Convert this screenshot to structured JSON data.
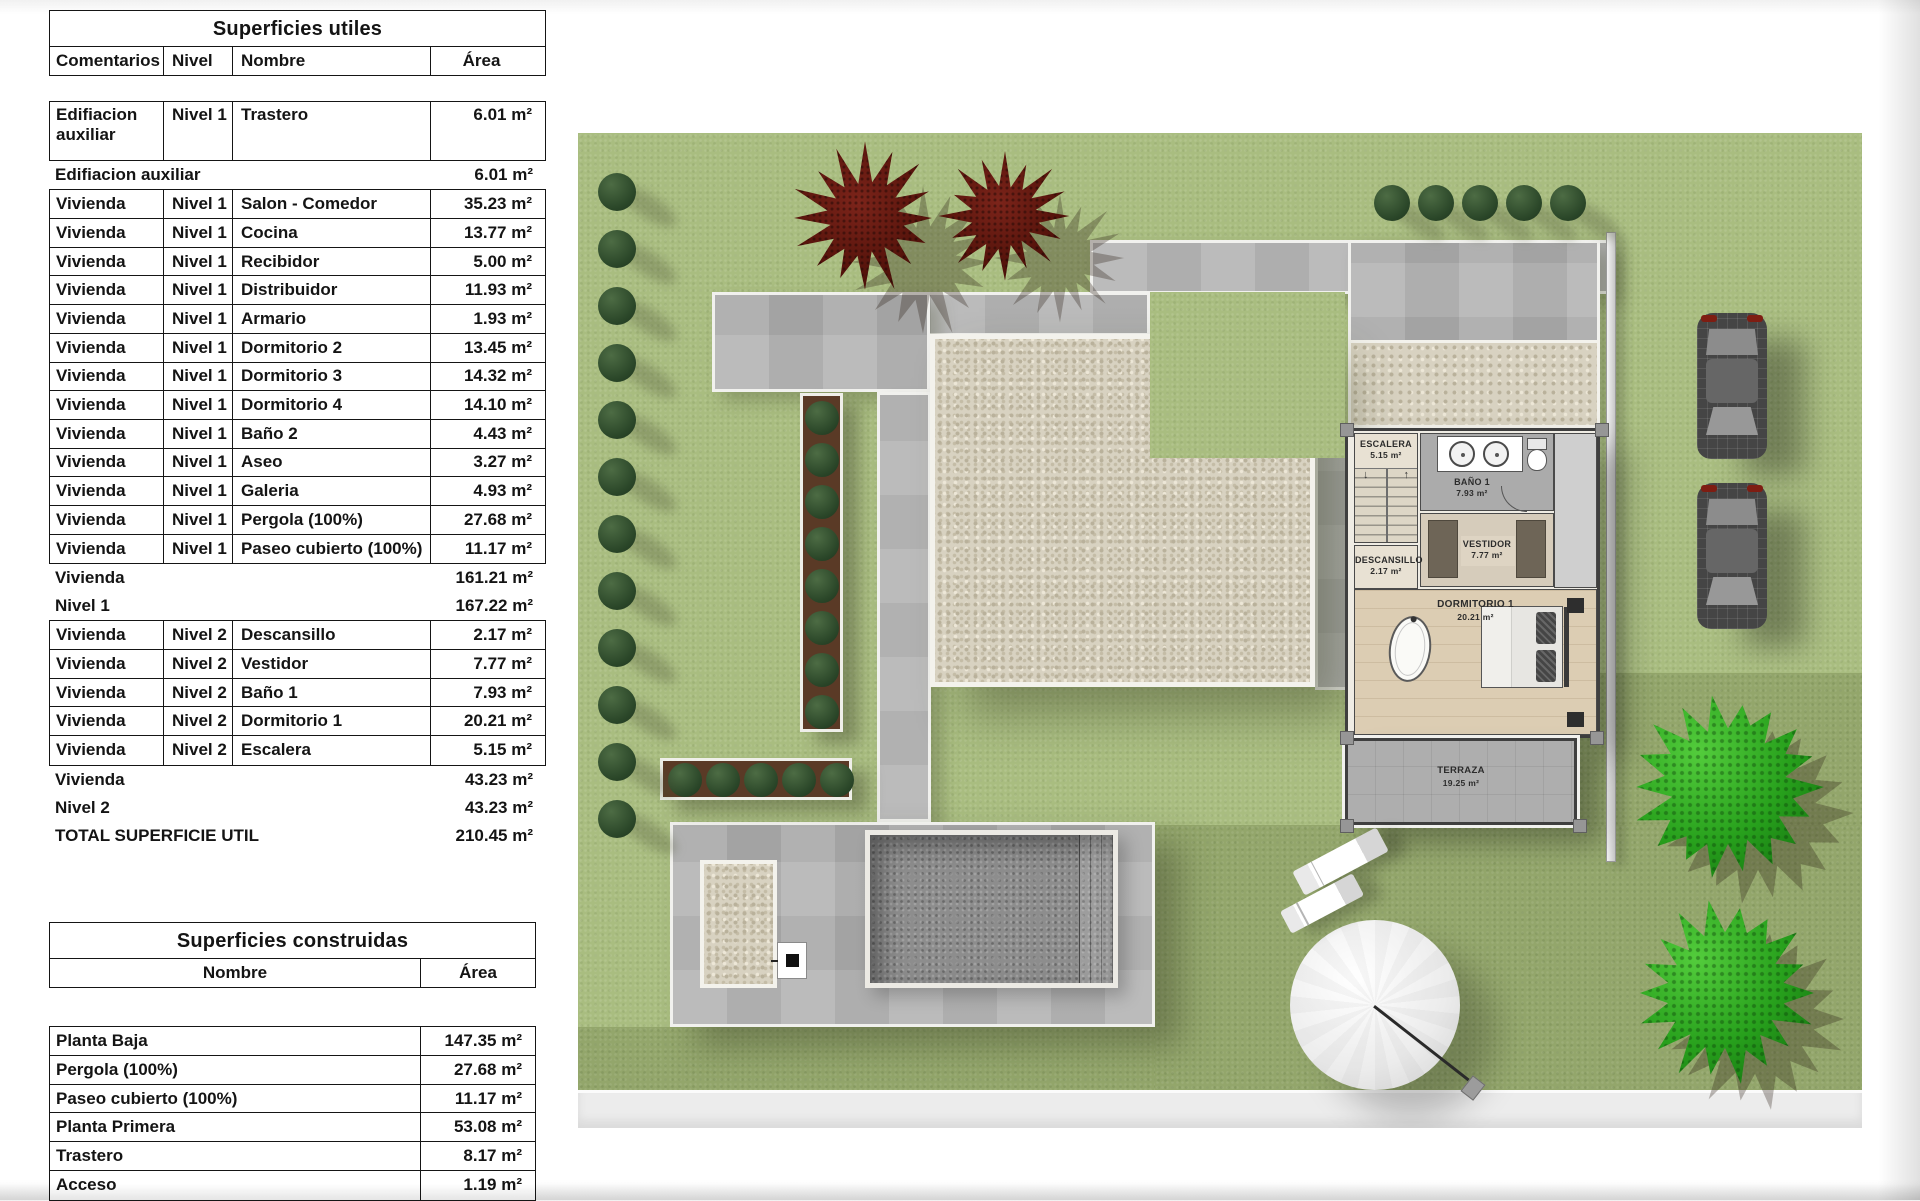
{
  "tables": {
    "utiles": {
      "title": "Superficies utiles",
      "headers": [
        "Comentarios",
        "Nivel",
        "Nombre",
        "Área"
      ],
      "rows": [
        {
          "type": "data",
          "tall": true,
          "comment": "Edifiacion auxiliar",
          "level": "Nivel 1",
          "name": "Trastero",
          "area": "6.01 m²"
        },
        {
          "type": "subtotal",
          "label": "Edifiacion auxiliar",
          "area": "6.01 m²"
        },
        {
          "type": "data",
          "comment": "Vivienda",
          "level": "Nivel 1",
          "name": "Salon - Comedor",
          "area": "35.23 m²"
        },
        {
          "type": "data",
          "comment": "Vivienda",
          "level": "Nivel 1",
          "name": "Cocina",
          "area": "13.77 m²"
        },
        {
          "type": "data",
          "comment": "Vivienda",
          "level": "Nivel 1",
          "name": "Recibidor",
          "area": "5.00 m²"
        },
        {
          "type": "data",
          "comment": "Vivienda",
          "level": "Nivel 1",
          "name": "Distribuidor",
          "area": "11.93 m²"
        },
        {
          "type": "data",
          "comment": "Vivienda",
          "level": "Nivel 1",
          "name": "Armario",
          "area": "1.93 m²"
        },
        {
          "type": "data",
          "comment": "Vivienda",
          "level": "Nivel 1",
          "name": "Dormitorio 2",
          "area": "13.45 m²"
        },
        {
          "type": "data",
          "comment": "Vivienda",
          "level": "Nivel 1",
          "name": "Dormitorio 3",
          "area": "14.32 m²"
        },
        {
          "type": "data",
          "comment": "Vivienda",
          "level": "Nivel 1",
          "name": "Dormitorio 4",
          "area": "14.10 m²"
        },
        {
          "type": "data",
          "comment": "Vivienda",
          "level": "Nivel 1",
          "name": "Baño 2",
          "area": "4.43 m²"
        },
        {
          "type": "data",
          "comment": "Vivienda",
          "level": "Nivel 1",
          "name": "Aseo",
          "area": "3.27 m²"
        },
        {
          "type": "data",
          "comment": "Vivienda",
          "level": "Nivel 1",
          "name": "Galeria",
          "area": "4.93 m²"
        },
        {
          "type": "data",
          "comment": "Vivienda",
          "level": "Nivel 1",
          "name": "Pergola (100%)",
          "area": "27.68 m²"
        },
        {
          "type": "data",
          "comment": "Vivienda",
          "level": "Nivel 1",
          "name": "Paseo cubierto (100%)",
          "area": "11.17 m²"
        },
        {
          "type": "subtotal",
          "label": "Vivienda",
          "area": "161.21 m²"
        },
        {
          "type": "subtotal",
          "label": "Nivel 1",
          "area": "167.22 m²"
        },
        {
          "type": "data",
          "comment": "Vivienda",
          "level": "Nivel 2",
          "name": "Descansillo",
          "area": "2.17 m²"
        },
        {
          "type": "data",
          "comment": "Vivienda",
          "level": "Nivel 2",
          "name": "Vestidor",
          "area": "7.77 m²"
        },
        {
          "type": "data",
          "comment": "Vivienda",
          "level": "Nivel 2",
          "name": "Baño 1",
          "area": "7.93 m²"
        },
        {
          "type": "data",
          "comment": "Vivienda",
          "level": "Nivel 2",
          "name": "Dormitorio 1",
          "area": "20.21 m²"
        },
        {
          "type": "data",
          "comment": "Vivienda",
          "level": "Nivel 2",
          "name": "Escalera",
          "area": "5.15 m²"
        },
        {
          "type": "subtotal",
          "label": "Vivienda",
          "area": "43.23 m²"
        },
        {
          "type": "subtotal",
          "label": "Nivel 2",
          "area": "43.23 m²"
        },
        {
          "type": "total",
          "label": "TOTAL SUPERFICIE UTIL",
          "area": "210.45 m²"
        }
      ]
    },
    "construidas": {
      "title": "Superficies construidas",
      "headers": [
        "Nombre",
        "Área"
      ],
      "rows": [
        {
          "name": "Planta Baja",
          "area": "147.35 m²"
        },
        {
          "name": "Pergola (100%)",
          "area": "27.68 m²"
        },
        {
          "name": "Paseo cubierto (100%)",
          "area": "11.17 m²"
        },
        {
          "name": "Planta Primera",
          "area": "53.08 m²"
        },
        {
          "name": "Trastero",
          "area": "8.17 m²"
        },
        {
          "name": "Acceso",
          "area": "1.19 m²"
        }
      ]
    }
  },
  "site_plan": {
    "rooms": {
      "escalera": {
        "name": "ESCALERA",
        "area": "5.15 m²"
      },
      "bano1": {
        "name": "BAÑO 1",
        "area": "7.93 m²"
      },
      "vestidor": {
        "name": "VESTIDOR",
        "area": "7.77 m²"
      },
      "descansillo": {
        "name": "DESCANSILLO",
        "area": "2.17 m²"
      },
      "dormitorio1": {
        "name": "DORMITORIO 1",
        "area": "20.21 m²"
      },
      "terraza": {
        "name": "TERRAZA",
        "area": "19.25 m²"
      }
    },
    "colors": {
      "lawn": "#a9bd80",
      "lawn_dark": "#93a66b",
      "paving": "#b3b3b3",
      "gravel": "#d8d2c1",
      "pool": "#8d8d8d",
      "bush": "#2b4729",
      "tree_red": "#55130b",
      "tree_green": "#27a01c"
    },
    "counts": {
      "left_bushes": 12,
      "top_bushes": 5,
      "planter_v_bushes": 8,
      "planter_h_bushes": 5,
      "red_trees": 2,
      "green_trees": 2,
      "cars": 2,
      "sun_loungers": 2,
      "parasols": 1
    }
  }
}
